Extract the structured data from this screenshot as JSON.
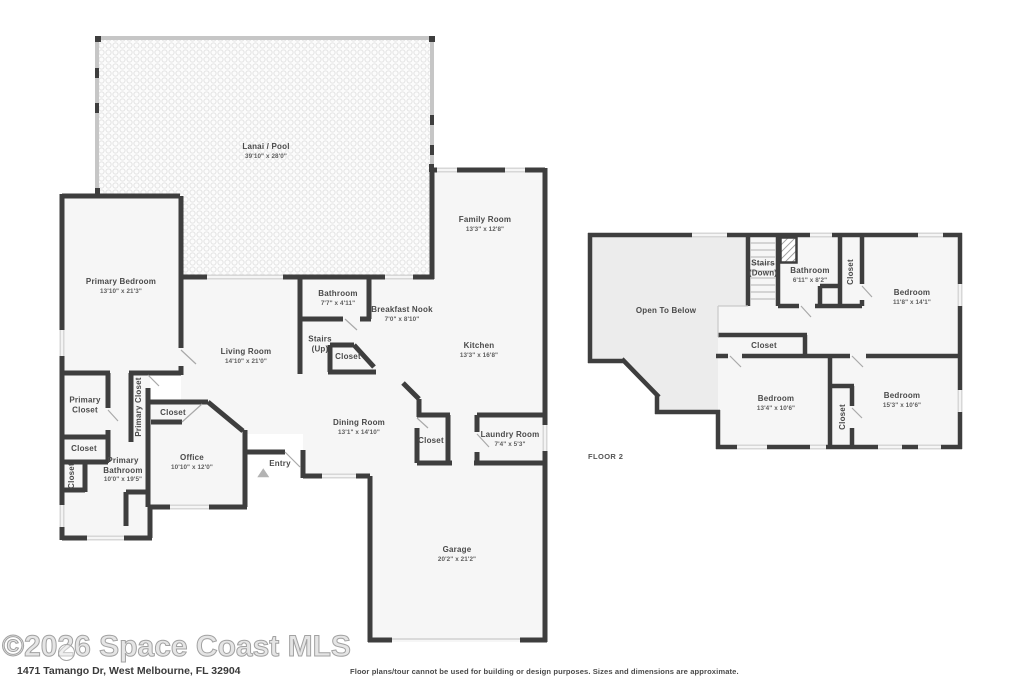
{
  "watermark": "©2026 Space Coast MLS",
  "address": "1471 Tamango Dr, West Melbourne, FL 32904",
  "disclaimer": "Floor plans/tour cannot be used for building or design purposes. Sizes and dimensions are approximate.",
  "floor2_label": "FLOOR 2",
  "colors": {
    "wall": "#3e3e3e",
    "room_fill": "#f6f6f6",
    "open_to_below_fill": "#ececec",
    "window": "#d7d7d7",
    "lanai_frame": "#c6c6c6",
    "label_text": "#4a4a4a"
  },
  "floor1": {
    "lanai": {
      "name": "Lanai / Pool",
      "dims": "39'10\" x 28'0\""
    },
    "family_room": {
      "name": "Family Room",
      "dims": "13'3\" x 12'8\""
    },
    "primary_bedroom": {
      "name": "Primary Bedroom",
      "dims": "13'10\" x 21'3\""
    },
    "bathroom": {
      "name": "Bathroom",
      "dims": "7'7\" x 4'11\""
    },
    "breakfast_nook": {
      "name": "Breakfast Nook",
      "dims": "7'0\" x 8'10\""
    },
    "stairs": {
      "line1": "Stairs",
      "line2": "(Up)"
    },
    "stairs_closet": {
      "name": "Closet"
    },
    "living_room": {
      "name": "Living Room",
      "dims": "14'10\" x 21'0\""
    },
    "kitchen": {
      "name": "Kitchen",
      "dims": "13'3\" x 16'8\""
    },
    "primary_closet_a": {
      "name": "Primary Closet"
    },
    "primary_closet_b": {
      "name": "Primary Closet"
    },
    "office_closet": {
      "name": "Closet"
    },
    "closet_small": {
      "name": "Closet"
    },
    "closet_vertical": {
      "name": "Closet"
    },
    "primary_bathroom": {
      "name": "Primary Bathroom",
      "dims": "10'0\" x 19'5\""
    },
    "office": {
      "name": "Office",
      "dims": "10'10\" x 12'0\""
    },
    "entry": {
      "name": "Entry"
    },
    "dining_room": {
      "name": "Dining Room",
      "dims": "13'1\" x 14'10\""
    },
    "dining_closet": {
      "name": "Closet"
    },
    "laundry_room": {
      "name": "Laundry Room",
      "dims": "7'4\" x 5'3\""
    },
    "garage": {
      "name": "Garage",
      "dims": "20'2\" x 21'2\""
    }
  },
  "floor2": {
    "open_to_below": {
      "name": "Open To Below"
    },
    "stairs": {
      "line1": "Stairs",
      "line2": "(Down)"
    },
    "bathroom": {
      "name": "Bathroom",
      "dims": "6'11\" x 8'2\""
    },
    "closet_top": {
      "name": "Closet"
    },
    "bedroom_right": {
      "name": "Bedroom",
      "dims": "11'8\" x 14'1\""
    },
    "hall_closet": {
      "name": "Closet"
    },
    "bedroom_middle": {
      "name": "Bedroom",
      "dims": "13'4\" x 10'6\""
    },
    "closet_bottom": {
      "name": "Closet"
    },
    "bedroom_bottom_right": {
      "name": "Bedroom",
      "dims": "15'3\" x 10'6\""
    }
  }
}
